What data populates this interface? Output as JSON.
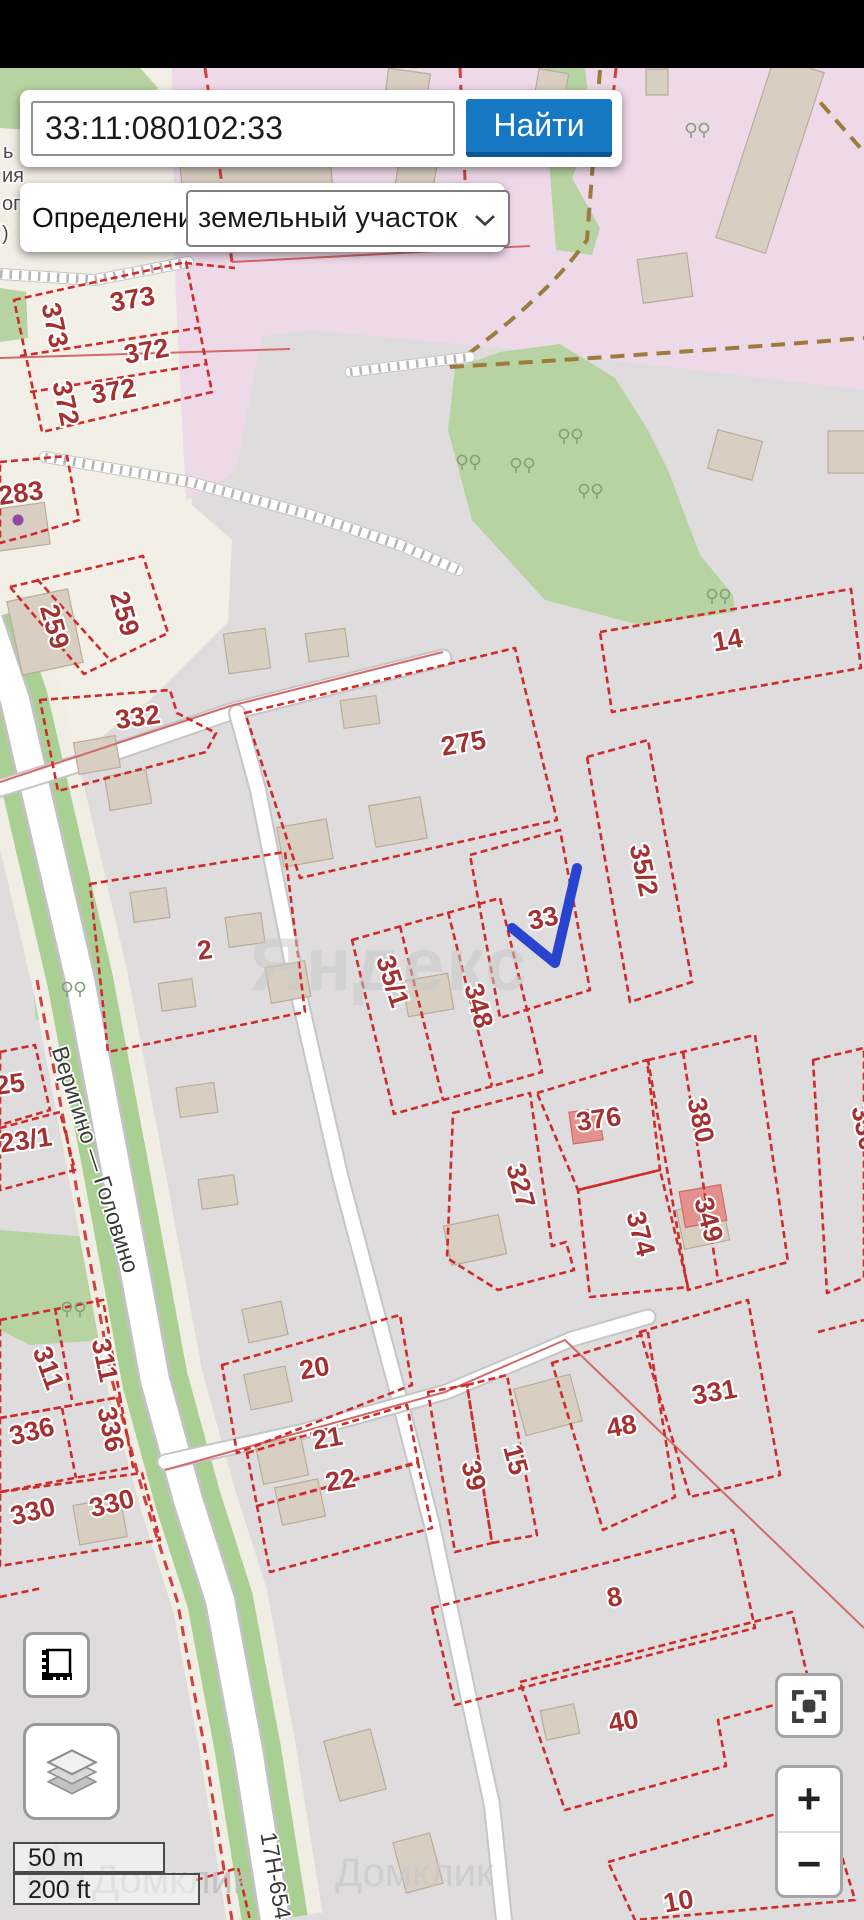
{
  "search": {
    "value": "33:11:080102:33",
    "button_label": "Найти"
  },
  "filter": {
    "label": "Определение:",
    "selected_option": "земельный участок"
  },
  "map_controls": {
    "zoom_in": "+",
    "zoom_out": "−",
    "scale_metric": "50 m",
    "scale_imperial": "200 ft"
  },
  "map": {
    "selected_parcel": "33",
    "parcel_labels": [
      {
        "t": "373",
        "x": 46,
        "y": 327,
        "r": 78
      },
      {
        "t": "373",
        "x": 134,
        "y": 308,
        "r": -10
      },
      {
        "t": "372",
        "x": 148,
        "y": 360,
        "r": -10
      },
      {
        "t": "372",
        "x": 57,
        "y": 405,
        "r": 78
      },
      {
        "t": "372",
        "x": 115,
        "y": 400,
        "r": -10
      },
      {
        "t": "283",
        "x": 22,
        "y": 502,
        "r": -8
      },
      {
        "t": "259",
        "x": 46,
        "y": 629,
        "r": 74
      },
      {
        "t": "259",
        "x": 116,
        "y": 616,
        "r": 74
      },
      {
        "t": "332",
        "x": 139,
        "y": 726,
        "r": -8
      },
      {
        "t": "2",
        "x": 206,
        "y": 959,
        "r": -8
      },
      {
        "t": "275",
        "x": 465,
        "y": 752,
        "r": -10
      },
      {
        "t": "14",
        "x": 729,
        "y": 649,
        "r": -10
      },
      {
        "t": "35/2",
        "x": 635,
        "y": 872,
        "r": 78
      },
      {
        "t": "33",
        "x": 545,
        "y": 927,
        "r": -12
      },
      {
        "t": "35/1",
        "x": 384,
        "y": 984,
        "r": 72
      },
      {
        "t": "348",
        "x": 470,
        "y": 1008,
        "r": 75
      },
      {
        "t": "25",
        "x": 11,
        "y": 1093,
        "r": -8
      },
      {
        "t": "23/1",
        "x": 27,
        "y": 1149,
        "r": -8
      },
      {
        "t": "327",
        "x": 512,
        "y": 1188,
        "r": 75
      },
      {
        "t": "376",
        "x": 600,
        "y": 1128,
        "r": -8
      },
      {
        "t": "380",
        "x": 692,
        "y": 1122,
        "r": 78
      },
      {
        "t": "374",
        "x": 632,
        "y": 1236,
        "r": 75
      },
      {
        "t": "349",
        "x": 700,
        "y": 1222,
        "r": 75
      },
      {
        "t": "330",
        "x": 856,
        "y": 1130,
        "r": 78
      },
      {
        "t": "311",
        "x": 40,
        "y": 1371,
        "r": 70
      },
      {
        "t": "311",
        "x": 96,
        "y": 1362,
        "r": 78
      },
      {
        "t": "336",
        "x": 34,
        "y": 1440,
        "r": -14
      },
      {
        "t": "336",
        "x": 102,
        "y": 1431,
        "r": 78
      },
      {
        "t": "330",
        "x": 35,
        "y": 1520,
        "r": -14
      },
      {
        "t": "330",
        "x": 114,
        "y": 1512,
        "r": -14
      },
      {
        "t": "20",
        "x": 316,
        "y": 1377,
        "r": -10
      },
      {
        "t": "21",
        "x": 329,
        "y": 1447,
        "r": -10
      },
      {
        "t": "22",
        "x": 342,
        "y": 1489,
        "r": -10
      },
      {
        "t": "39",
        "x": 465,
        "y": 1478,
        "r": 75
      },
      {
        "t": "15",
        "x": 507,
        "y": 1462,
        "r": 75
      },
      {
        "t": "48",
        "x": 623,
        "y": 1435,
        "r": -10
      },
      {
        "t": "331",
        "x": 716,
        "y": 1401,
        "r": -10
      },
      {
        "t": "8",
        "x": 616,
        "y": 1606,
        "r": -10
      },
      {
        "t": "40",
        "x": 625,
        "y": 1730,
        "r": -10
      },
      {
        "t": "10",
        "x": 680,
        "y": 1910,
        "r": -10
      }
    ],
    "street_labels": [
      {
        "t": "Веригино — Головино",
        "x": 88,
        "y": 1162,
        "r": 72
      },
      {
        "t": "17Н-654",
        "x": 268,
        "y": 1877,
        "r": 80
      }
    ],
    "edge_labels": [
      {
        "t": "ь",
        "x": 3,
        "y": 158
      },
      {
        "t": "ия",
        "x": 2,
        "y": 182
      },
      {
        "t": "ого",
        "x": 2,
        "y": 210
      },
      {
        "t": ")",
        "x": 2,
        "y": 240
      }
    ],
    "watermarks": {
      "center": "Яндекс",
      "bottom": "Домклик"
    }
  },
  "colors": {
    "accent_blue": "#1678c2",
    "parcel_red": "#cf2b2b",
    "parcel_label_red": "#a33131",
    "selected_blue": "#2743cf",
    "zone_pink": "#eed9e9",
    "settlement_beige": "#f2efe7",
    "cadastral_grey": "#dedcdc",
    "forest_green": "#b7d3a1",
    "building_tan": "#d8cec1",
    "building_pink": "#e4908c"
  }
}
